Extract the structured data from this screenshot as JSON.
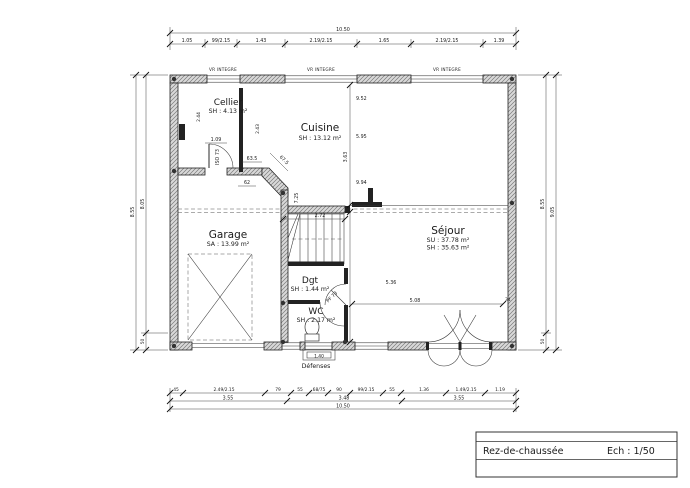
{
  "plan": {
    "rooms": {
      "cellier": {
        "name": "Cellier",
        "area": "SH : 4.13 m²"
      },
      "cuisine": {
        "name": "Cuisine",
        "area": "SH : 13.12 m²"
      },
      "garage": {
        "name": "Garage",
        "area": "SA : 13.99 m²"
      },
      "sejour": {
        "name": "Séjour",
        "area_su": "SU : 37.78 m²",
        "area_sh": "SH : 35.63 m²"
      },
      "dgt": {
        "name": "Dgt",
        "area": "SH : 1.44 m²"
      },
      "wc": {
        "name": "WC",
        "area": "SH : 2.17 m²"
      }
    },
    "labels": {
      "vr": "VR INTEGRE",
      "iso": "ISO 73",
      "pf": "PF 73",
      "defenses": "Défenses"
    },
    "dims": {
      "top_total": "10.50",
      "top": [
        "1.05",
        "99/2.15",
        "1.43",
        "2.19/2.15",
        "1.65",
        "2.19/2.15",
        "1.39"
      ],
      "bottom1": [
        "45",
        "2.49/2.15",
        "79",
        "55",
        "68/75",
        "90",
        "99/2.15",
        "55",
        "1.36",
        "1.49/2.15",
        "1.19"
      ],
      "bottom2": [
        "3.55",
        "3.48",
        "3.55"
      ],
      "bottom_total": "10.50",
      "left": {
        "outer": "8.55",
        "inner": "8.05",
        "small": "50"
      },
      "right": {
        "outer": "9.05",
        "inner": "8.55",
        "small": "50"
      },
      "interior": {
        "cellier_door": "1.09",
        "cellier_h1": "2.44",
        "cellier_h2": "2.43",
        "k1": "63.5",
        "k2": "62",
        "k3": "67.5",
        "v1": "9.52",
        "v2": "5.95",
        "v3": "3.63",
        "v4": "9.94",
        "v5": "7.25",
        "stair": "2.72",
        "s1": "5.36",
        "s2": "5.08",
        "s3": "34",
        "entry": "1.40"
      }
    },
    "titleblock": {
      "title": "Rez-de-chaussée",
      "scale": "Ech : 1/50"
    }
  }
}
